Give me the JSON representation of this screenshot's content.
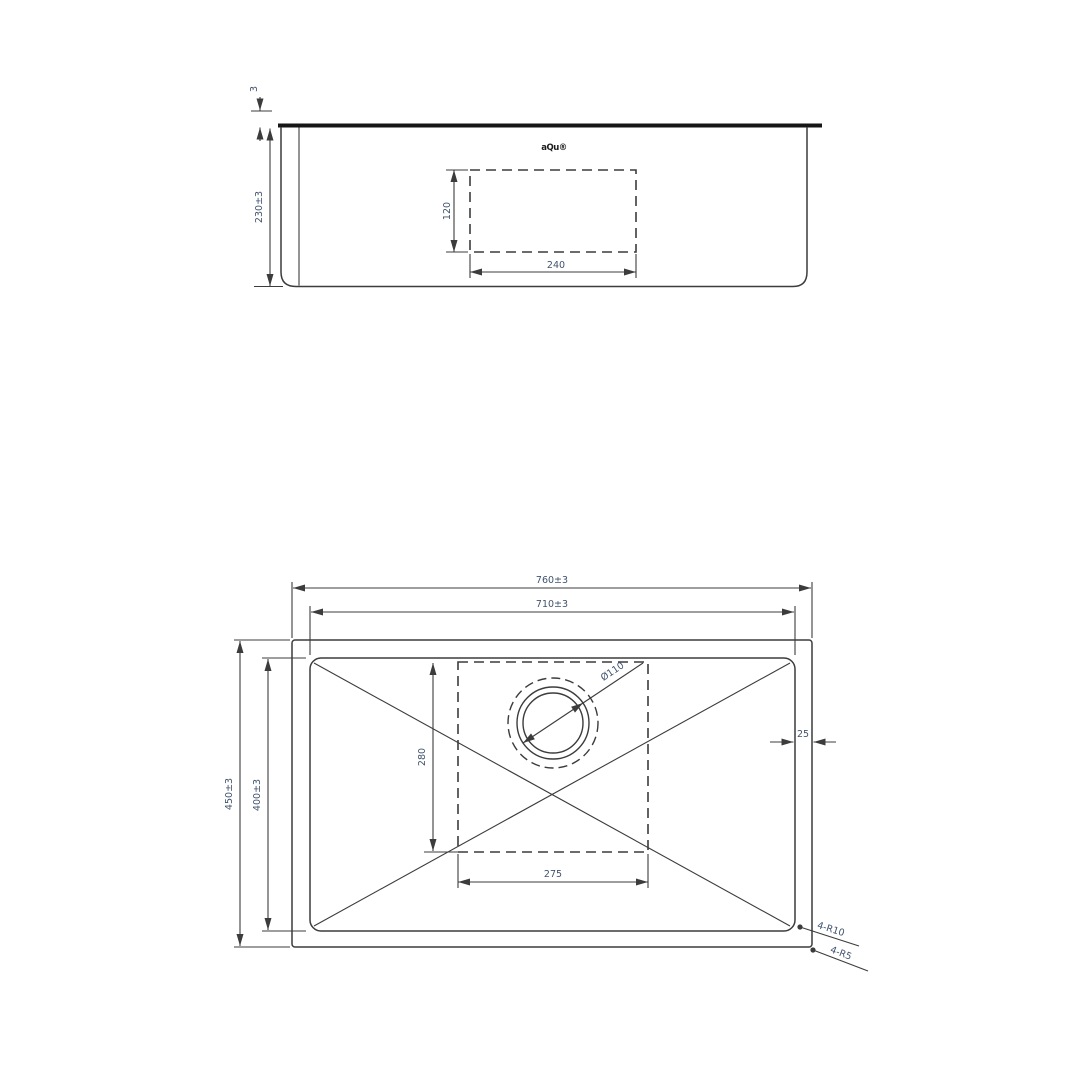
{
  "logo": "aQu®",
  "side_view": {
    "rim_thickness": "3",
    "overall_height": "230±3",
    "cutout_height": "120",
    "cutout_width": "240"
  },
  "plan_view": {
    "overall_width": "760±3",
    "bowl_width": "710±3",
    "overall_depth": "450±3",
    "bowl_depth": "400±3",
    "drain_zone_depth": "280",
    "drain_zone_width": "275",
    "rim_margin": "25",
    "drain_diameter": "Ø110",
    "bowl_corner_radius": "4-R10",
    "outer_corner_radius": "4-R5"
  },
  "colors": {
    "line": "#3c3c3c",
    "rim_line": "#161616",
    "dim_text": "#41536e",
    "background": "#ffffff"
  }
}
